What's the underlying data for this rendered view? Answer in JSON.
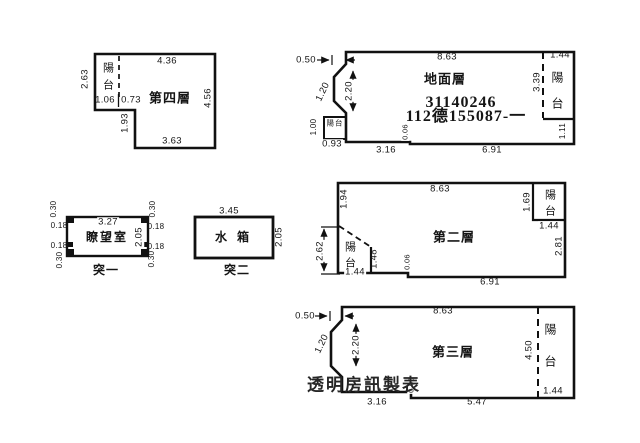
{
  "floor4": {
    "title": "第四層",
    "balcony": "陽台",
    "top": "4.36",
    "left": "2.63",
    "right": "4.56",
    "bottom": "3.63",
    "w1": "1.06",
    "w2": "0.73",
    "notch": "1.93"
  },
  "ground": {
    "title": "地面層",
    "reg_line1": "31140246",
    "reg_line2": "112德155087-一",
    "offset": "0.50",
    "top": "8.63",
    "top_right": "1.44",
    "h_step": "2.20",
    "w_step": "1.20",
    "balcony_small": "陽台",
    "bal_h": "1.00",
    "bal_w": "0.93",
    "bottom1": "3.16",
    "gap": "0.06",
    "bottom2": "6.91",
    "balcony_right": "陽台",
    "bal_r_h": "3.39",
    "bottom_right": "1.11"
  },
  "tower": {
    "title": "瞭望室",
    "caption": "突一",
    "top": "3.27",
    "side": "2.05",
    "corner": "0.30",
    "edge": "0.18"
  },
  "tank": {
    "title": "水箱",
    "caption": "突二",
    "top": "3.45",
    "side": "2.05"
  },
  "floor2": {
    "title": "第二層",
    "top": "8.63",
    "left_top": "1.94",
    "left": "2.62",
    "balcony_left": "陽台",
    "bl_w": "1.44",
    "bl_h": "1.48",
    "gap": "0.06",
    "bottom": "6.91",
    "balcony_right": "陽台",
    "rt_h": "1.69",
    "rt_w": "1.44",
    "right": "2.81"
  },
  "floor3": {
    "title": "第三層",
    "offset": "0.50",
    "top": "8.63",
    "w_step": "1.20",
    "h_step": "2.20",
    "right_h": "4.50",
    "balcony": "陽台",
    "bottom_right": "1.44",
    "gap": "0.06",
    "bottom1": "3.16",
    "bottom2": "5.47",
    "watermark": "透明房訊製表"
  }
}
